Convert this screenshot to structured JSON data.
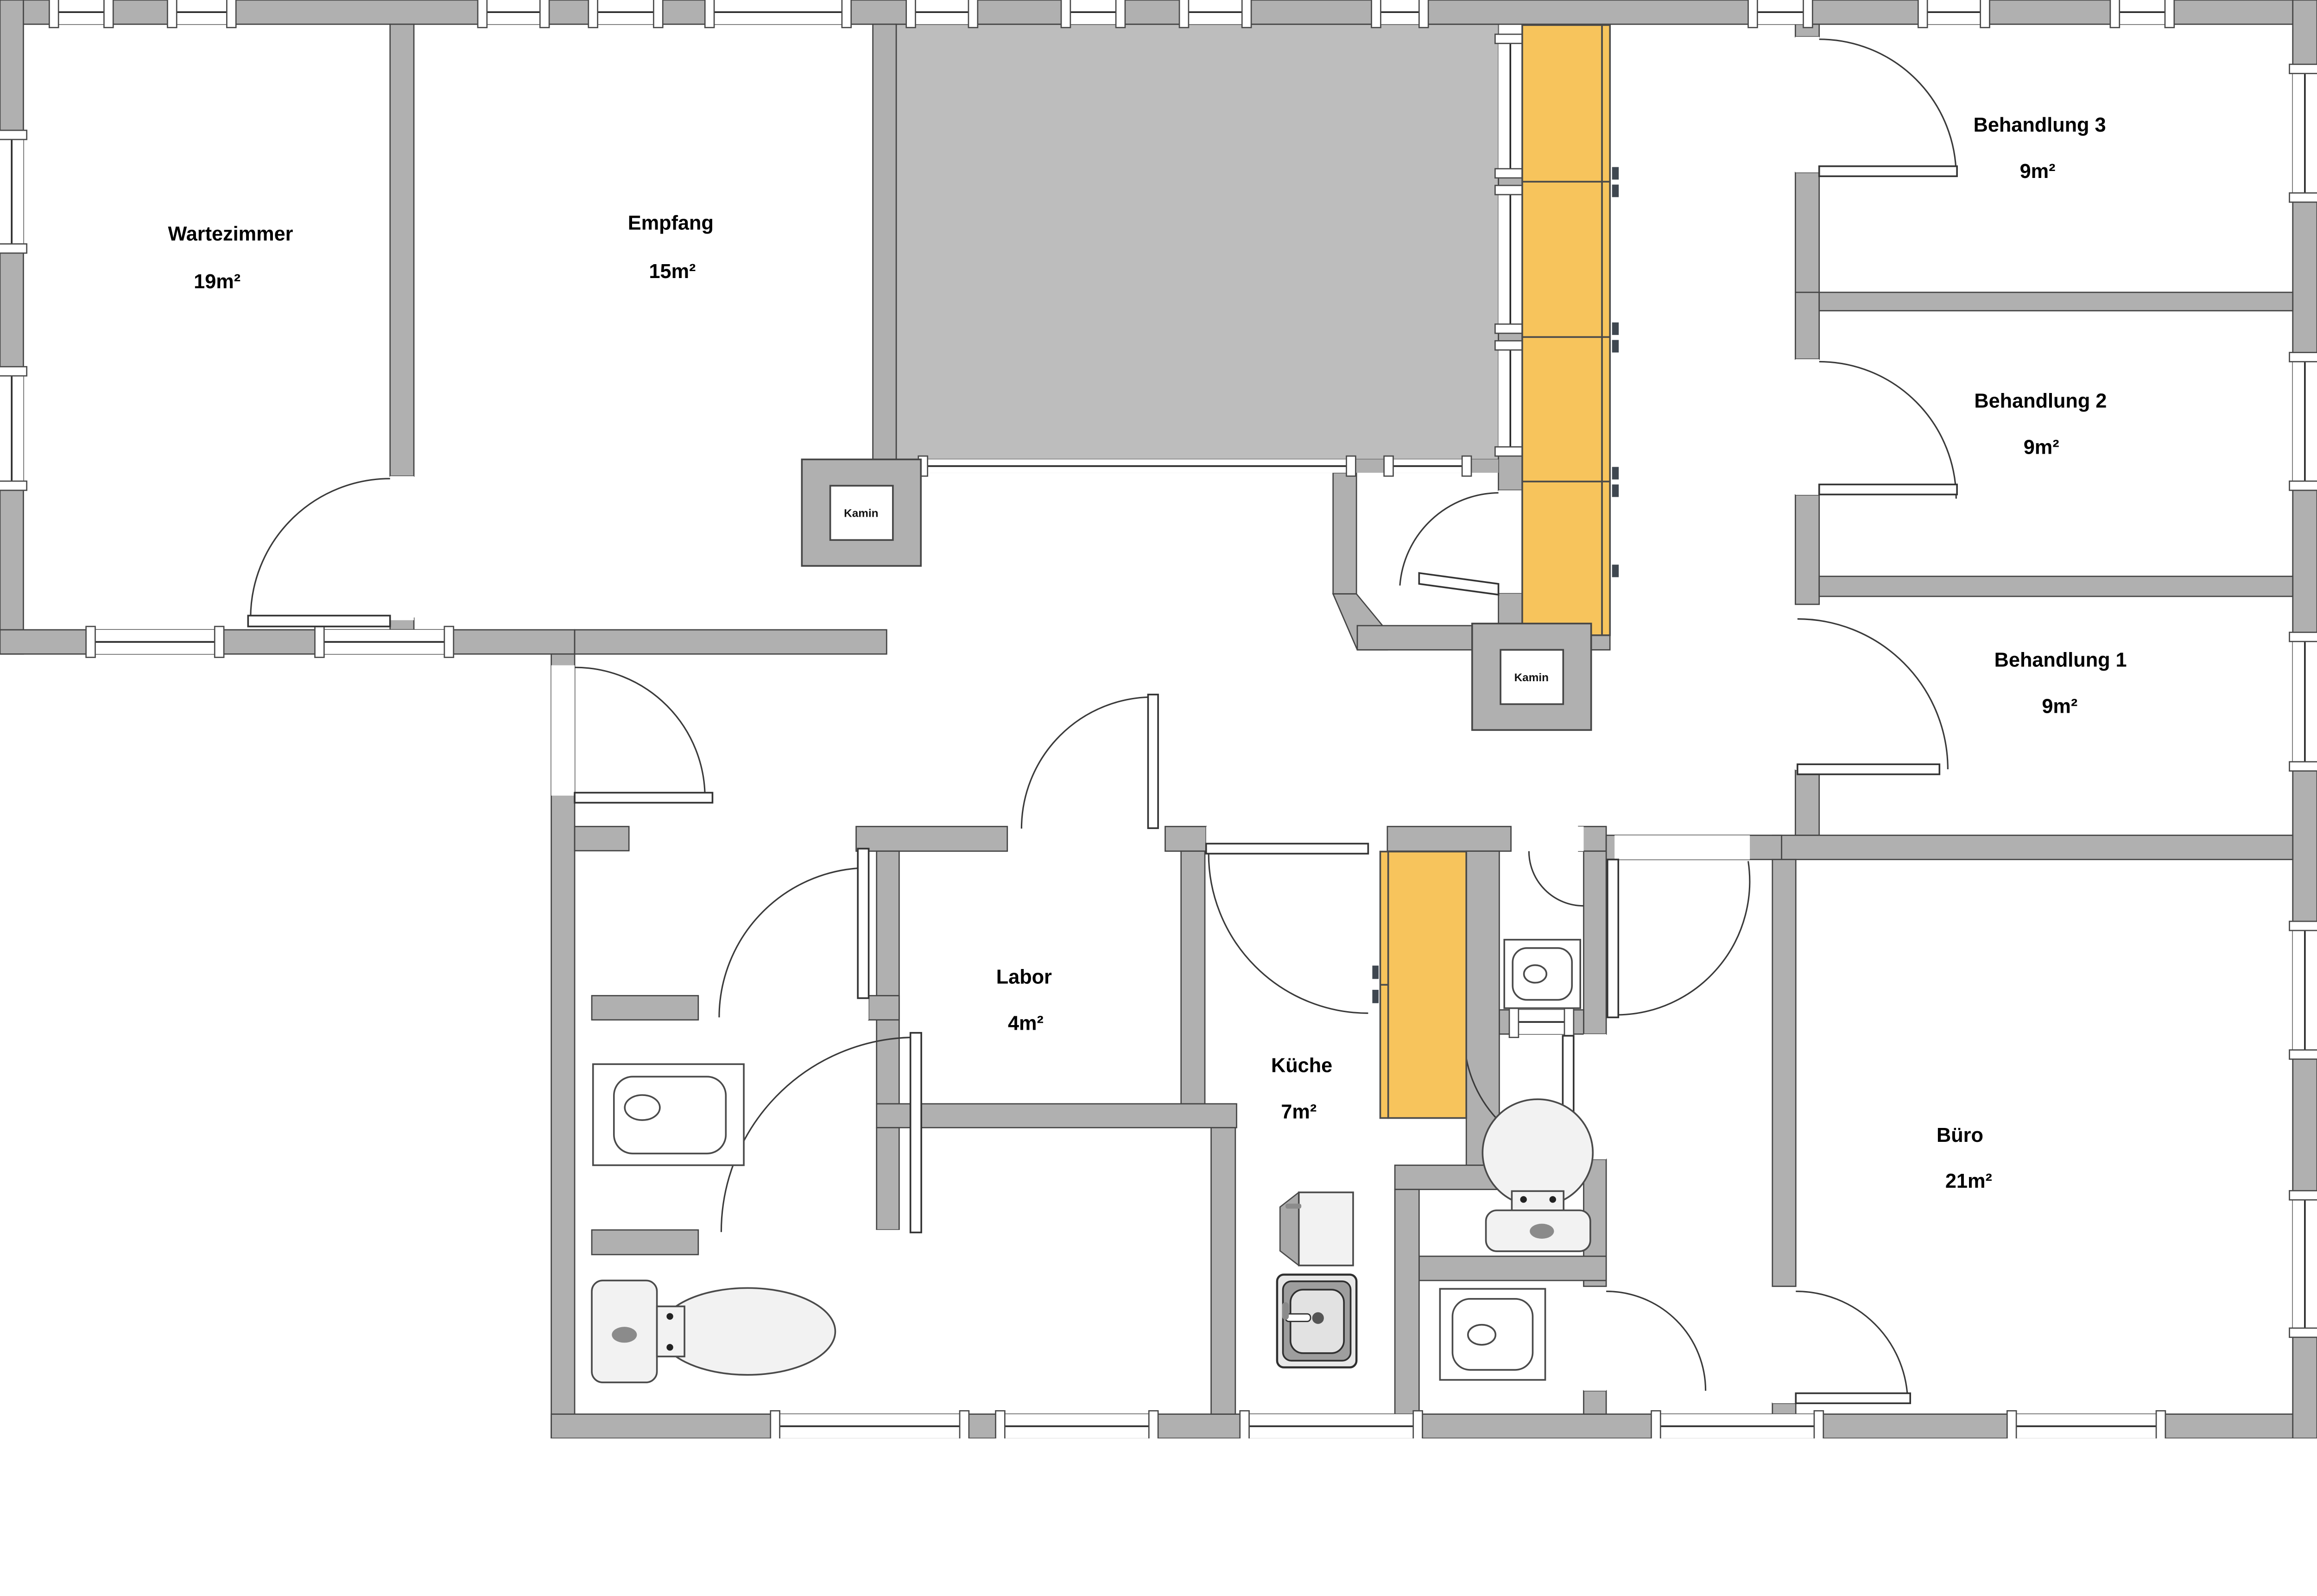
{
  "plan_title": "Praxis-Grundriss",
  "rooms": [
    {
      "id": "wartezimmer",
      "name": "Wartezimmer",
      "area": "19m²"
    },
    {
      "id": "empfang",
      "name": "Empfang",
      "area": "15m²"
    },
    {
      "id": "behandlung3",
      "name": "Behandlung 3",
      "area": "9m²"
    },
    {
      "id": "behandlung2",
      "name": "Behandlung 2",
      "area": "9m²"
    },
    {
      "id": "behandlung1",
      "name": "Behandlung 1",
      "area": "9m²"
    },
    {
      "id": "labor",
      "name": "Labor",
      "area": "4m²"
    },
    {
      "id": "kueche",
      "name": "Küche",
      "area": "7m²"
    },
    {
      "id": "buero",
      "name": "Büro",
      "area": "21m²"
    }
  ],
  "fireplaces": [
    {
      "label": "Kamin"
    },
    {
      "label": "Kamin"
    }
  ],
  "colors": {
    "wall_gray": "#b0b0b0",
    "terrace_gray": "#bdbdbd",
    "cabinet_orange": "#f7c45c",
    "fixture_light": "#f2f2f2",
    "background": "#ffffff",
    "text": "#000000"
  }
}
